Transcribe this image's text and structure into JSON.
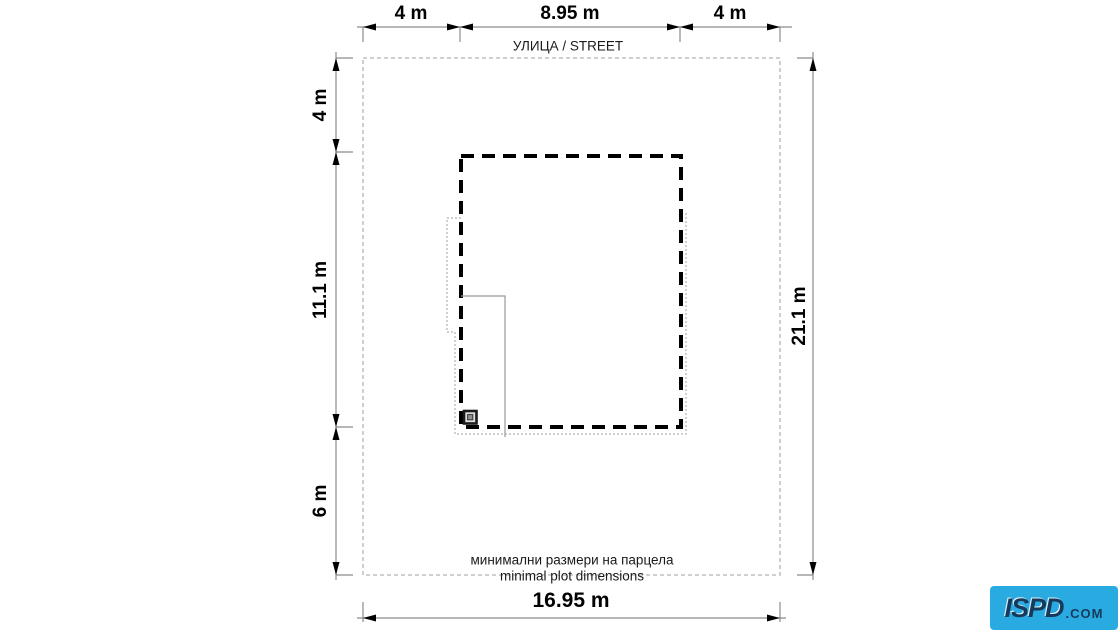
{
  "diagram": {
    "street_label": "УЛИЦА / STREET",
    "caption_line1": "минимални размери на парцела",
    "caption_line2": "minimal plot dimensions",
    "dimensions": {
      "top": [
        "4 m",
        "8.95 m",
        "4 m"
      ],
      "left": [
        "4 m",
        "11.1 m",
        "6 m"
      ],
      "right": "21.1 m",
      "bottom": "16.95 m"
    },
    "plot": {
      "width_m": "16.95",
      "depth_m": "21.1"
    },
    "building": {
      "width_m": "8.95",
      "depth_m": "11.1",
      "front_setback_m": "4",
      "rear_setback_m": "6",
      "side_setback_m": "4"
    },
    "colors": {
      "dimension_line": "#8c8c8c",
      "dimension_text": "#000000",
      "plot_boundary": "#b3b3b3",
      "building_outline": "#000000",
      "house_outline": "#b0b0b0",
      "partition_line": "#999999"
    }
  },
  "logo": {
    "brand": "ISPD",
    "suffix": ".COM",
    "background": "#29abe2",
    "text_color": "#17395c"
  }
}
